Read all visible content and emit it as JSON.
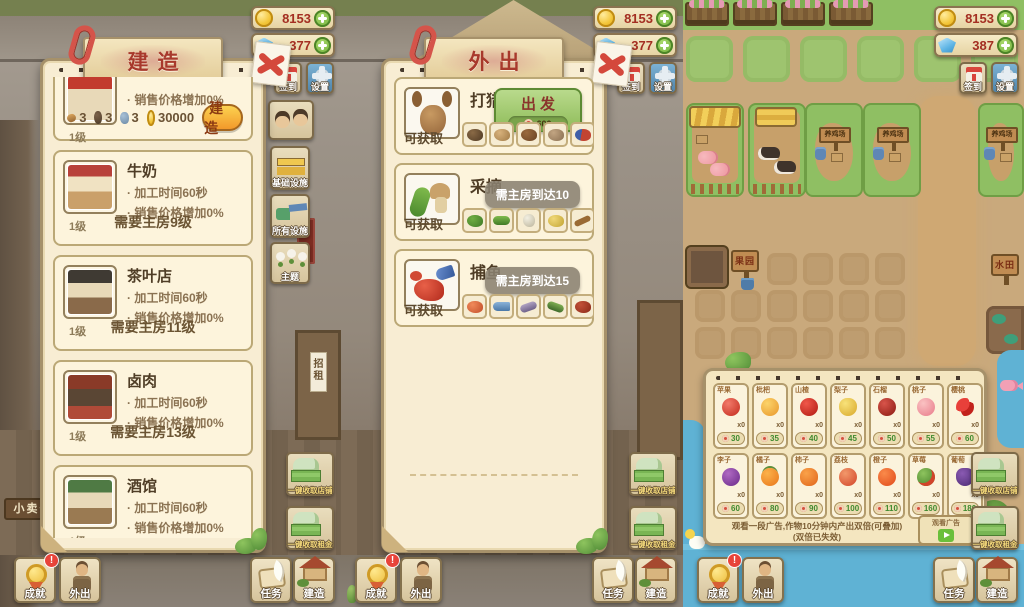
{
  "hud": {
    "coins": "8153",
    "gems_build": "377",
    "gems_outing": "377",
    "gems_farm": "387",
    "signin": "签到",
    "settings": "设置"
  },
  "side_menu": {
    "infra": "基础设施",
    "facilities": "所有设施",
    "theme": "主题",
    "collect_shop": "一键收取店铺",
    "collect_rent": "一键收取租金"
  },
  "scene": {
    "kiosk": "小卖部",
    "rent": "招租"
  },
  "bottom_bar": {
    "achievement": "成就",
    "outing": "外出",
    "tasks": "任务",
    "build": "建造",
    "badge": "!"
  },
  "build_panel": {
    "title": "建造",
    "partial_item": {
      "desc": "· 销售价格增加0%",
      "level": "1级",
      "cost_wood": "3",
      "cost_ore": "3",
      "cost_stone": "3",
      "cost_coin": "30000",
      "action": "建造"
    },
    "items": [
      {
        "name": "牛奶",
        "line1": "· 加工时间60秒",
        "line2": "· 销售价格增加0%",
        "level": "1级",
        "requirement": "需要主房9级"
      },
      {
        "name": "茶叶店",
        "line1": "· 加工时间60秒",
        "line2": "· 销售价格增加0%",
        "level": "1级",
        "requirement": "需要主房11级"
      },
      {
        "name": "卤肉",
        "line1": "· 加工时间60秒",
        "line2": "· 销售价格增加0%",
        "level": "1级",
        "requirement": "需要主房13级"
      },
      {
        "name": "酒馆",
        "line1": "· 加工时间60秒",
        "line2": "· 销售价格增加0%",
        "level": "1级"
      }
    ]
  },
  "outing_panel": {
    "title": "外出",
    "obtain": "可获取",
    "hunt": {
      "name": "打猎",
      "action": "出发",
      "timer": "600"
    },
    "gather": {
      "name": "采摘",
      "requirement": "需主房到达10"
    },
    "fish": {
      "name": "捕鱼",
      "requirement": "需主房到达15"
    }
  },
  "farm_panel": {
    "pen_sign": "养鸡场",
    "orchard_sign": "果园",
    "paddy_sign": "水田",
    "ad_line1": "观看一段广告,作物10分钟内产出双倍(可叠加)",
    "ad_line2": "(双倍已失效)",
    "ad_button": "观看广告",
    "seed_cards": [
      {
        "name": "苹果",
        "time": "30",
        "count": "x0"
      },
      {
        "name": "枇杷",
        "time": "35",
        "count": "x0"
      },
      {
        "name": "山楂",
        "time": "40",
        "count": "x0"
      },
      {
        "name": "梨子",
        "time": "45",
        "count": "x0"
      },
      {
        "name": "石榴",
        "time": "50",
        "count": "x0"
      },
      {
        "name": "桃子",
        "time": "55",
        "count": "x0"
      },
      {
        "name": "樱桃",
        "time": "60",
        "count": "x0"
      },
      {
        "name": "李子",
        "time": "60",
        "count": "x0"
      },
      {
        "name": "橘子",
        "time": "80",
        "count": "x0"
      },
      {
        "name": "柿子",
        "time": "90",
        "count": "x0"
      },
      {
        "name": "荔枝",
        "time": "100",
        "count": "x0"
      },
      {
        "name": "橙子",
        "time": "110",
        "count": "x0"
      },
      {
        "name": "草莓",
        "time": "160",
        "count": "x0"
      },
      {
        "name": "葡萄",
        "time": "180",
        "count": "x0"
      }
    ]
  }
}
